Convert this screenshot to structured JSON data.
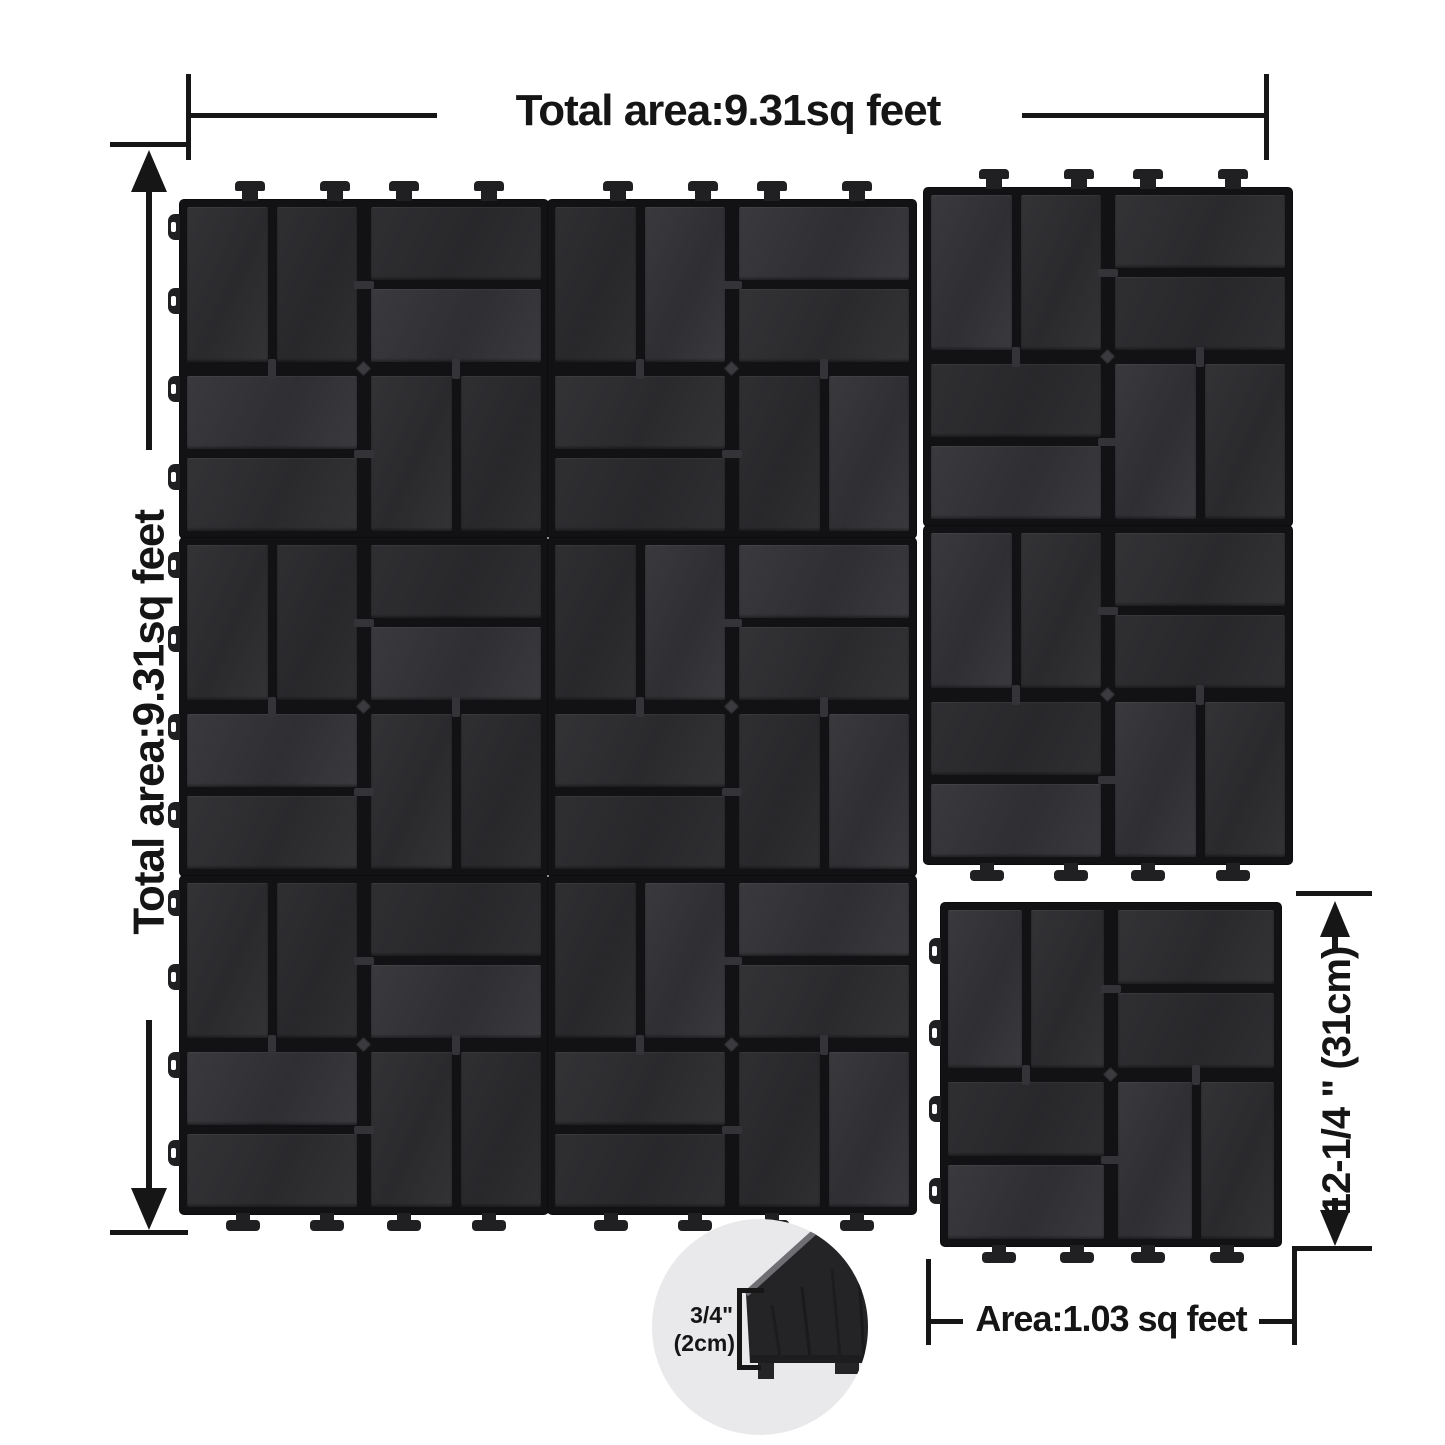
{
  "dimensions": {
    "total_area_top": "Total area:9.31sq feet",
    "total_area_left": "Total area:9.31sq feet",
    "tile_height": "12-1/4 \" (31cm)",
    "tile_area": "Area:1.03 sq feet",
    "thickness_in": "3/4\"",
    "thickness_cm": "(2cm)"
  },
  "colors": {
    "line": "#161616",
    "text": "#151515",
    "tile_base": "#121214",
    "tab": "#202023",
    "slat_variants": [
      [
        "#333336",
        "#2a2a2d"
      ],
      [
        "#2f2f32",
        "#28282b"
      ],
      [
        "#3a3a3e",
        "#2f2f33"
      ]
    ],
    "inset_bg": "#e9e9eb",
    "slab": "#242427",
    "bevel": "#6e6e73"
  },
  "assembly": {
    "description": "Eight interlocked 12x12 inch deck tiles (3 columns, right column 2 rows) plus one separate tile at lower right; basket-weave slat pattern",
    "tile_w": 368,
    "tile_h": 338,
    "cols_x": [
      180,
      548,
      924
    ],
    "rows_y": [
      200,
      538,
      876
    ],
    "col3_offset_y": -12,
    "top_tab_fr": [
      0.19,
      0.42,
      0.61,
      0.84
    ],
    "left_tab_fr": [
      0.08,
      0.3,
      0.56,
      0.82
    ],
    "foot_fr": [
      0.17,
      0.4,
      0.61,
      0.84
    ],
    "main_tiles": [
      {
        "col": 0,
        "row": 0,
        "tabs": [
          "top",
          "left"
        ]
      },
      {
        "col": 1,
        "row": 0,
        "tabs": [
          "top"
        ]
      },
      {
        "col": 2,
        "row": 0,
        "tabs": [
          "top"
        ]
      },
      {
        "col": 0,
        "row": 1,
        "tabs": [
          "left"
        ]
      },
      {
        "col": 1,
        "row": 1,
        "tabs": []
      },
      {
        "col": 2,
        "row": 1,
        "tabs": [
          "bottom"
        ]
      },
      {
        "col": 0,
        "row": 2,
        "tabs": [
          "left",
          "bottom"
        ]
      },
      {
        "col": 1,
        "row": 2,
        "tabs": [
          "bottom"
        ]
      }
    ],
    "single_tile": {
      "x": 941,
      "y": 903,
      "w": 340,
      "h": 343,
      "tabs": [
        "left",
        "bottom"
      ],
      "left_fr": [
        0.14,
        0.38,
        0.6,
        0.84
      ],
      "name": "single-deck-tile"
    }
  }
}
